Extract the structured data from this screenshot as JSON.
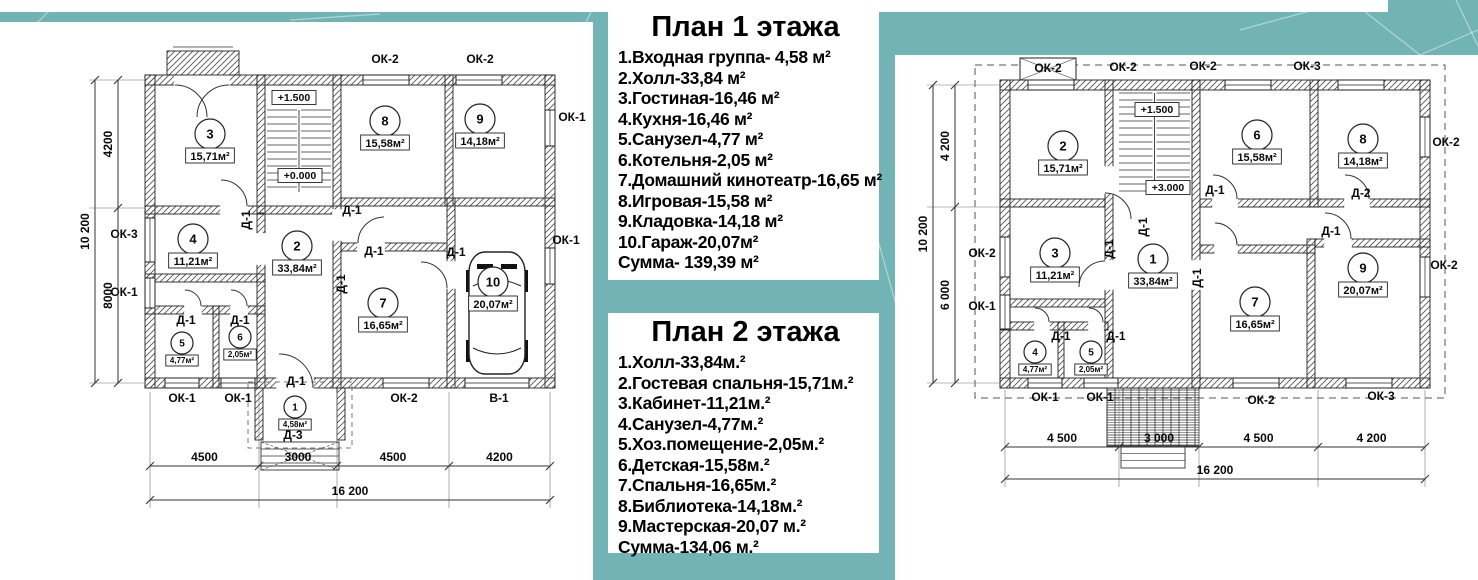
{
  "page": {
    "background_color": "#72b4b5",
    "panel_color": "#ffffff"
  },
  "legend1": {
    "title": "План 1 этажа",
    "items": [
      "1.Входная группа- 4,58 м²",
      "2.Холл-33,84 м²",
      "3.Гостиная-16,46 м²",
      "4.Кухня-16,46 м²",
      "5.Санузел-4,77 м²",
      "6.Котельня-2,05 м²",
      "7.Домашний кинотеатр-16,65 м²",
      "8.Игровая-15,58 м²",
      "9.Кладовка-14,18 м²",
      "10.Гараж-20,07м²",
      "Сумма- 139,39 м²"
    ]
  },
  "legend2": {
    "title": "План 2 этажа",
    "items": [
      "1.Холл-33,84м.²",
      "2.Гостевая спальня-15,71м.²",
      "3.Кабинет-11,21м.²",
      "4.Санузел-4,77м.²",
      "5.Хоз.помещение-2,05м.²",
      "6.Детская-15,58м.²",
      "7.Спальня-16,65м.²",
      "8.Библиотека-14,18м.²",
      "9.Мастерская-20,07 м.²",
      "Сумма-134,06 м.²"
    ]
  },
  "plan1": {
    "rooms": [
      {
        "n": "3",
        "a": "15,71м²",
        "x": 210,
        "y": 112
      },
      {
        "n": "8",
        "a": "15,58м²",
        "x": 385,
        "y": 99
      },
      {
        "n": "9",
        "a": "14,18м²",
        "x": 480,
        "y": 97
      },
      {
        "n": "4",
        "a": "11,21м²",
        "x": 193,
        "y": 217
      },
      {
        "n": "2",
        "a": "33,84м²",
        "x": 297,
        "y": 224
      },
      {
        "n": "5",
        "a": "4,77м²",
        "x": 182,
        "y": 321,
        "s": 1
      },
      {
        "n": "6",
        "a": "2,05м²",
        "x": 240,
        "y": 315,
        "s": 1
      },
      {
        "n": "7",
        "a": "16,65м²",
        "x": 383,
        "y": 281
      },
      {
        "n": "10",
        "a": "20,07м²",
        "x": 493,
        "y": 260
      },
      {
        "n": "1",
        "a": "4,58м²",
        "x": 295,
        "y": 385,
        "s": 1
      }
    ],
    "marks": [
      {
        "t": "ОК-2",
        "x": 385,
        "y": 41
      },
      {
        "t": "ОК-2",
        "x": 480,
        "y": 41
      },
      {
        "t": "ОК-1",
        "x": 572,
        "y": 99
      },
      {
        "t": "ОК-1",
        "x": 566,
        "y": 222
      },
      {
        "t": "ОК-3",
        "x": 124,
        "y": 216
      },
      {
        "t": "ОК-1",
        "x": 124,
        "y": 274
      },
      {
        "t": "ОК-1",
        "x": 182,
        "y": 380
      },
      {
        "t": "ОК-1",
        "x": 238,
        "y": 380
      },
      {
        "t": "Д-1",
        "x": 296,
        "y": 363
      },
      {
        "t": "ОК-2",
        "x": 404,
        "y": 380
      },
      {
        "t": "В-1",
        "x": 499,
        "y": 380
      },
      {
        "t": "Д-1",
        "x": 250,
        "y": 198,
        "r": -90
      },
      {
        "t": "Д-1",
        "x": 352,
        "y": 192
      },
      {
        "t": "Д-1",
        "x": 345,
        "y": 262,
        "r": -90
      },
      {
        "t": "Д-1",
        "x": 186,
        "y": 302
      },
      {
        "t": "Д-1",
        "x": 240,
        "y": 302
      },
      {
        "t": "Д-1",
        "x": 374,
        "y": 233
      },
      {
        "t": "Д-1",
        "x": 456,
        "y": 234
      },
      {
        "t": "Д-3",
        "x": 293,
        "y": 417
      }
    ],
    "levels": [
      {
        "t": "+1.500",
        "x": 294,
        "y": 79
      },
      {
        "t": "+0.000",
        "x": 300,
        "y": 157
      }
    ],
    "dims": {
      "bottom": [
        "4500",
        "3000",
        "4500",
        "4200"
      ],
      "bottom_total": "16 200",
      "left": [
        "4200",
        "8000"
      ],
      "left_total": "10 200"
    }
  },
  "plan2": {
    "rooms": [
      {
        "n": "2",
        "a": "15,71м²",
        "x": 168,
        "y": 91
      },
      {
        "n": "6",
        "a": "15,58м²",
        "x": 362,
        "y": 80
      },
      {
        "n": "8",
        "a": "14,18м²",
        "x": 468,
        "y": 84
      },
      {
        "n": "3",
        "a": "11,21м²",
        "x": 160,
        "y": 198
      },
      {
        "n": "1",
        "a": "33,84м²",
        "x": 258,
        "y": 204
      },
      {
        "n": "4",
        "a": "4,77м²",
        "x": 140,
        "y": 297,
        "s": 1
      },
      {
        "n": "5",
        "a": "2,05м²",
        "x": 196,
        "y": 297,
        "s": 1
      },
      {
        "n": "7",
        "a": "16,65м²",
        "x": 360,
        "y": 247
      },
      {
        "n": "9",
        "a": "20,07м²",
        "x": 468,
        "y": 213
      }
    ],
    "marks": [
      {
        "t": "ОК-2",
        "x": 153,
        "y": 17
      },
      {
        "t": "ОК-2",
        "x": 228,
        "y": 16
      },
      {
        "t": "ОК-2",
        "x": 308,
        "y": 15
      },
      {
        "t": "ОК-3",
        "x": 412,
        "y": 15
      },
      {
        "t": "ОК-2",
        "x": 551,
        "y": 91
      },
      {
        "t": "ОК-2",
        "x": 549,
        "y": 214
      },
      {
        "t": "ОК-2",
        "x": 87,
        "y": 202
      },
      {
        "t": "ОК-1",
        "x": 87,
        "y": 255
      },
      {
        "t": "ОК-1",
        "x": 150,
        "y": 346
      },
      {
        "t": "ОК-1",
        "x": 205,
        "y": 346
      },
      {
        "t": "ОК-2",
        "x": 366,
        "y": 349
      },
      {
        "t": "ОК-3",
        "x": 486,
        "y": 345
      },
      {
        "t": "Д-1",
        "x": 320,
        "y": 139
      },
      {
        "t": "Д-2",
        "x": 466,
        "y": 142
      },
      {
        "t": "Д-1",
        "x": 218,
        "y": 194,
        "r": -90
      },
      {
        "t": "Д-1",
        "x": 252,
        "y": 172,
        "r": -90
      },
      {
        "t": "Д-1",
        "x": 166,
        "y": 285
      },
      {
        "t": "Д-1",
        "x": 221,
        "y": 285
      },
      {
        "t": "Д-1",
        "x": 436,
        "y": 180
      },
      {
        "t": "Д-1",
        "x": 306,
        "y": 223,
        "r": -90
      }
    ],
    "levels": [
      {
        "t": "+1.500",
        "x": 262,
        "y": 58
      },
      {
        "t": "+3.000",
        "x": 273,
        "y": 136
      }
    ],
    "dims": {
      "bottom": [
        "4 500",
        "3 000",
        "4 500",
        "4 200"
      ],
      "bottom_total": "16 200",
      "left": [
        "4 200",
        "6 000"
      ],
      "left_total": "10 200"
    }
  }
}
